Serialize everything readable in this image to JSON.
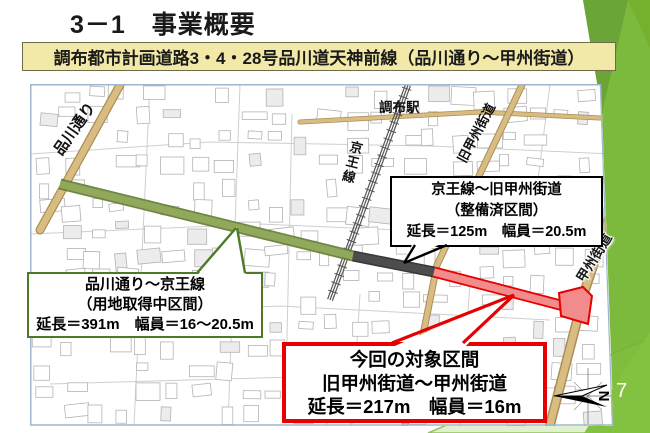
{
  "slide": {
    "title": "3－1　事業概要",
    "page_number": "7"
  },
  "banner": {
    "text": "調布都市計画道路3・4・28号品川道天神前線（品川通り～甲州街道）"
  },
  "map": {
    "labels": {
      "shinagawa_dori": "品川通り",
      "chofu_station": "調布駅",
      "keio_line": "京王線",
      "kyu_koshu_kaido": "旧甲州街道",
      "koshu_kaido": "甲州街道"
    },
    "compass": {
      "north_label": "N"
    },
    "callouts": {
      "completed": {
        "line1": "京王線～旧甲州街道",
        "line2": "（整備済区間）",
        "line3": "延長＝125m　幅員＝20.5m"
      },
      "acquiring": {
        "line1": "品川通り～京王線",
        "line2": "（用地取得中区間）",
        "line3": "延長＝391m　幅員＝16～20.5m"
      },
      "target": {
        "line1": "今回の対象区間",
        "line2": "旧甲州街道～甲州街道",
        "line3": "延長＝217m　幅員＝16m"
      }
    },
    "segments": [
      {
        "name": "品川通り～京王線",
        "status": "用地取得中区間",
        "color": "#96AC5E"
      },
      {
        "name": "京王線～旧甲州街道",
        "status": "整備済区間",
        "color": "#4D4D4D"
      },
      {
        "name": "旧甲州街道～甲州街道",
        "status": "今回の対象区間",
        "color": "#F28B8B"
      }
    ]
  },
  "colors": {
    "accent_green": "#7CBA3E",
    "accent_green_dark": "#6BA437",
    "banner_bg": "#F2E9A8",
    "target_red": "#E60000",
    "completed_black": "#000000",
    "acquiring_green": "#4E7A28",
    "road_tan": "#D9BC82"
  }
}
